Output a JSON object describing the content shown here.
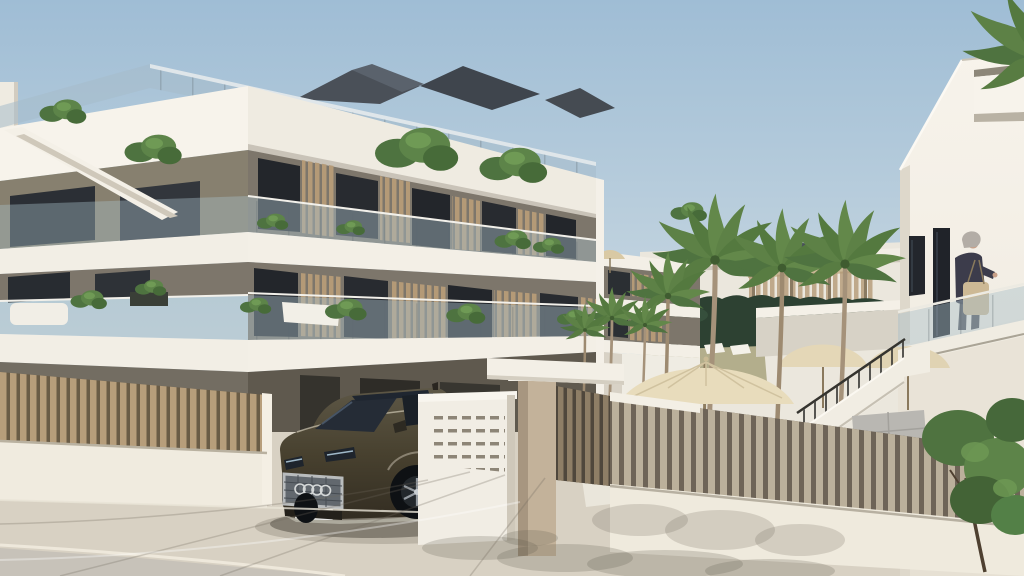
{
  "image": {
    "kind": "architectural exterior render",
    "description": "Sunny 3D visualisation of a modern three-storey apartment building with white fascia bands, glass balconies and timber slat screens; palm-lined pool courtyard with pergola, parasols and timber furniture behind a slatted fence; entrance gate with letterbox wall and beige pillar; dark bronze SUV parked at the driveway; white neighbouring building with an elevated walkway where a grey-haired woman with a beige tote bag walks; pale stone street in the foreground."
  },
  "palette": {
    "sky_top": "#9fbdd5",
    "sky_mid": "#c6d6e0",
    "sky_horizon": "#e7ebec",
    "facade_white_sun": "#f6f2ea",
    "facade_white": "#efebe1",
    "facade_shade": "#ded8cb",
    "wall_taupe": "#7d766b",
    "wall_taupe_dark": "#5f594e",
    "window_glass": "#23262c",
    "balustrade_glass": "rgba(168,190,200,0.45)",
    "roof_dark": "#49505a",
    "fence_slat": "#b79e7b",
    "fence_backing": "#6a5c46",
    "patio_slat": "#bbb09b",
    "pillar_beige": "#c3b29a",
    "hedge_green": "#2d4132",
    "palm_green": "#5d8146",
    "lawn": "#b3ae8c",
    "parasol": "#e8dcbc",
    "pavement": "#d8d1c3",
    "street": "#c7c2b9",
    "car_body": "#4a4334",
    "car_glass": "#222933",
    "chrome": "#b9bcbd"
  },
  "building_left": {
    "storeys_visible": 3,
    "features": [
      "white fascia bands",
      "rooftop terrace with planters and glass rail",
      "dark angular roof forms",
      "glass balcony balustrades",
      "timber slat privacy screens",
      "full-height dark glazing",
      "white outdoor sofa",
      "balcony plants",
      "external stair parapet on side face"
    ]
  },
  "courtyard": {
    "palm_trees_large": 3,
    "palm_trees_small": 5,
    "features": [
      "dark green hedge",
      "timber pergola",
      "white sun loungers",
      "large beige parasol",
      "two beige terrace canopies",
      "timber dining table and chairs",
      "white lounger",
      "grey outdoor sofa",
      "staircase with white parapet and dark handrail",
      "timber slat fence on low white wall"
    ]
  },
  "entrance": {
    "features": [
      "white letterbox wall with vent grid",
      "beige pillar with white coping",
      "white lintel beam",
      "timber slat pedestrian gate",
      "driveway opening"
    ]
  },
  "vehicle": {
    "type": "SUV",
    "colour": "dark bronze",
    "grille_rings": 4,
    "details": [
      "chrome-framed mesh grille",
      "licence plate",
      "dark glazing",
      "alloy wheel",
      "chrome bumper lip"
    ]
  },
  "person": {
    "description": "grey-haired woman carrying a beige tote bag",
    "location": "elevated walkway of right-hand white building"
  },
  "right_building": {
    "features": [
      "sloping white parapet",
      "projecting balcony box",
      "overhanging palm fronds",
      "two dark window slots",
      "glass-balustrade walkway",
      "recessed door",
      "leafy tree at base"
    ]
  }
}
